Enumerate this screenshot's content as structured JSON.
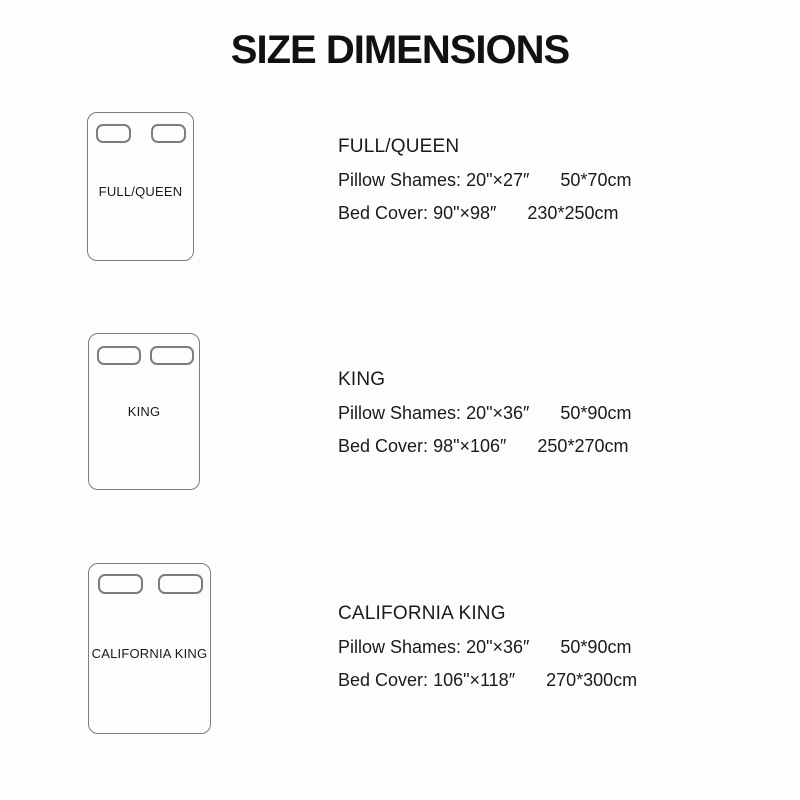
{
  "title": "SIZE DIMENSIONS",
  "sizes": [
    {
      "name": "FULL/QUEEN",
      "diagram_label": "FULL/QUEEN",
      "pillow_label": "Pillow Shames:",
      "pillow_inches": "20\"×27″",
      "pillow_cm": "50*70cm",
      "cover_label": "Bed Cover:",
      "cover_inches": "90\"×98″",
      "cover_cm": "230*250cm"
    },
    {
      "name": "KING",
      "diagram_label": "KING",
      "pillow_label": "Pillow Shames:",
      "pillow_inches": "20\"×36″",
      "pillow_cm": "50*90cm",
      "cover_label": "Bed Cover:",
      "cover_inches": "98\"×106″",
      "cover_cm": "250*270cm"
    },
    {
      "name": "CALIFORNIA KING",
      "diagram_label": "CALIFORNIA KING",
      "pillow_label": "Pillow Shames:",
      "pillow_inches": "20\"×36″",
      "pillow_cm": "50*90cm",
      "cover_label": "Bed Cover:",
      "cover_inches": "106\"×118″",
      "cover_cm": "270*300cm"
    }
  ],
  "colors": {
    "background": "#fdfdfd",
    "title": "#111111",
    "text": "#1a1a1a",
    "outline": "#7d7d7d"
  }
}
